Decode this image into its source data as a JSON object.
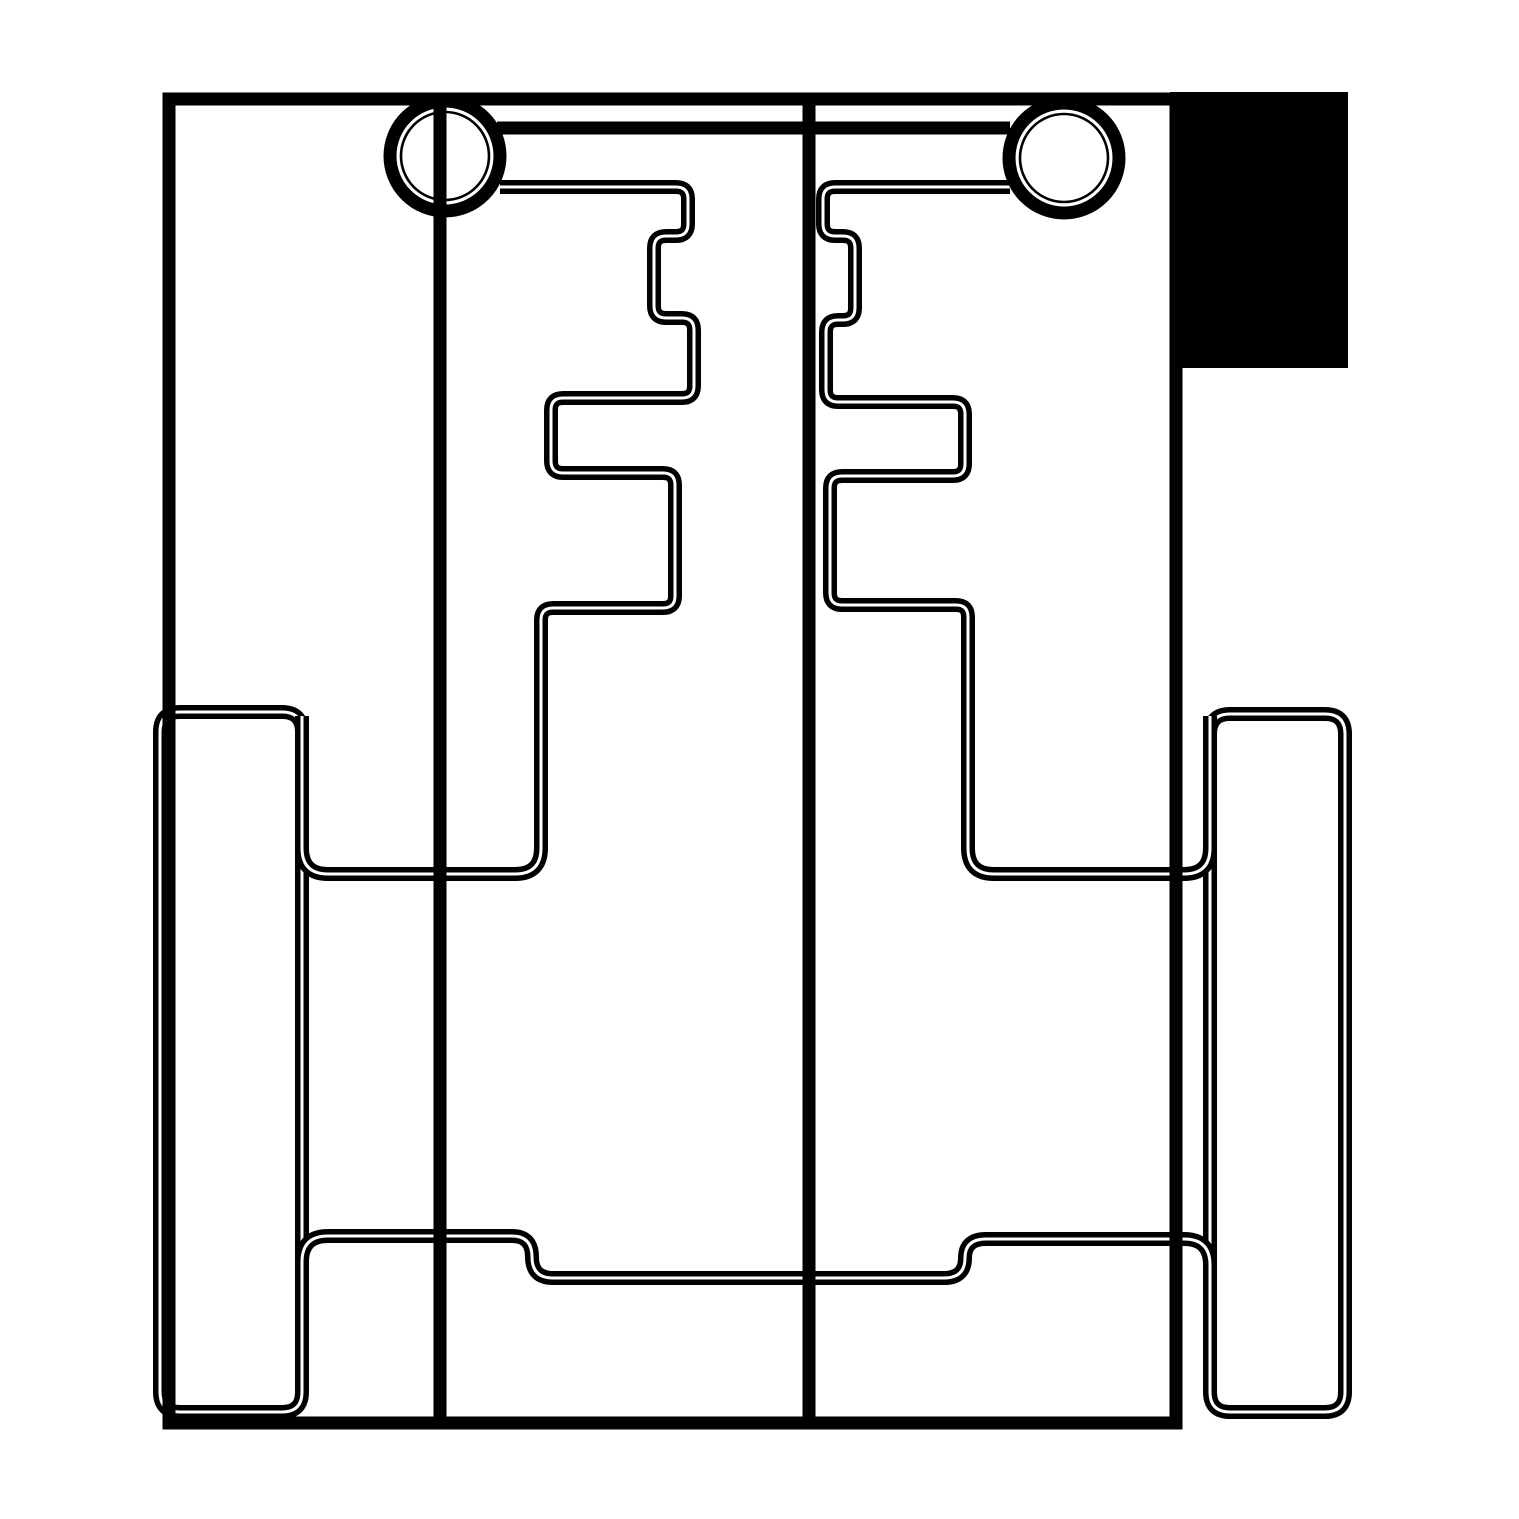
{
  "meta": {
    "kind": "technical-line-drawing",
    "description": "monochrome CAD outline drawing of a mechanism: two pin circles linked by a top bar, mirrored stepped key profiles, two side rails, filled block at top right",
    "ink_color": "#000000",
    "paper_color": "#ffffff"
  },
  "canvas": {
    "width": 1519,
    "height": 1519,
    "viewBox": "0 0 1519 1519"
  },
  "shapes": {
    "black_block": {
      "x": 1170,
      "y": 92,
      "width": 178,
      "height": 276
    },
    "paths": {
      "body_rect": "M 169 99 L 1176 99 L 1176 1423 L 169 1423 Z",
      "top_border": "M 163 99 L 1176 99",
      "center_line": "M 809 99 L 809 1423",
      "chord_line": "M 440 95 L 440 1423",
      "top_bar": "M 497 128 L 1010 128",
      "left_rail": "M 180 712 L 282 712 Q 302 712 302 732 L 302 1392 Q 302 1412 282 1412 L 180 1412 Q 160 1412 160 1392 L 160 732 Q 160 712 180 712 Z",
      "right_rail": "M 1230 714 L 1325 714 Q 1345 714 1345 734 L 1345 1392 Q 1345 1412 1325 1412 L 1230 1412 Q 1210 1412 1210 1392 L 1210 734 Q 1210 714 1230 714 Z",
      "left_assembly": "M 500 187 L 676 187 Q 688 187 688 199 L 688 224 Q 688 236 676 236 L 666 236 Q 654 236 654 248 L 654 306 Q 654 318 666 318 L 682 318 Q 694 318 694 330 L 694 386 Q 694 398 682 398 L 563 398 Q 551 398 551 410 L 551 461 Q 551 473 563 473 L 663 473 Q 675 473 675 485 L 675 596 Q 675 608 663 608 L 553 608 Q 541 608 541 620 L 541 848 Q 541 874 515 874 L 328 874 Q 302 874 302 848 L 302 716",
      "right_assembly": "M 1010 187 L 835 187 Q 823 187 823 199 L 823 224 Q 823 236 835 236 L 843 236 Q 855 236 855 248 L 855 308 Q 855 320 843 320 L 838 320 Q 826 320 826 332 L 826 390 Q 826 402 838 402 L 953 402 Q 965 402 965 414 L 965 464 Q 965 476 953 476 L 842 476 Q 830 476 830 488 L 830 593 Q 830 605 842 605 L 956 605 Q 968 605 968 617 L 968 848 Q 968 874 994 874 L 1184 874 Q 1210 874 1210 848 L 1210 716",
      "lower_link": "M 302 1340 L 302 1262 Q 302 1236 328 1236 L 512 1236 Q 532 1236 532 1257 Q 532 1278 553 1278 L 944 1278 Q 965 1278 965 1258 Q 965 1239 986 1239 L 1184 1239 Q 1210 1239 1210 1265 L 1210 1340"
    },
    "circles": {
      "left": {
        "cx": 445,
        "cy": 156,
        "r_fill": 61,
        "r_ring": 55,
        "r_inner": 44
      },
      "right": {
        "cx": 1064,
        "cy": 158,
        "r_fill": 61,
        "r_ring": 55,
        "r_inner": 44
      }
    }
  }
}
